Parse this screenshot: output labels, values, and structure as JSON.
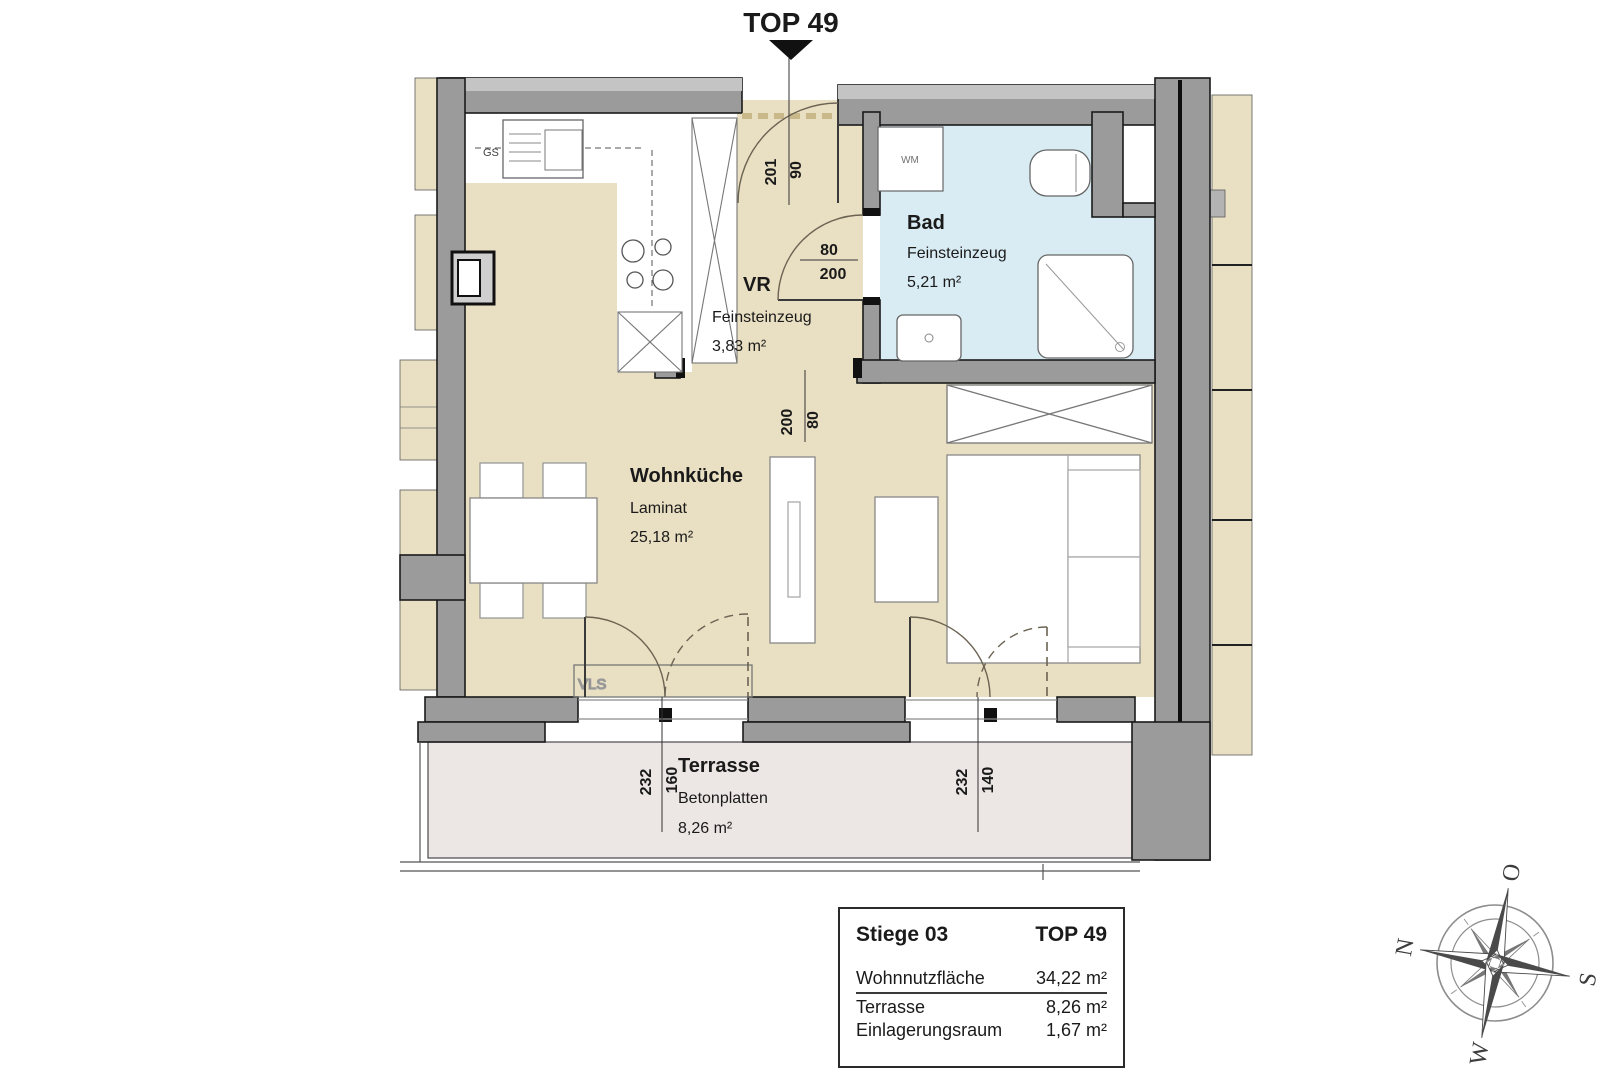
{
  "plan": {
    "top_label": "TOP 49",
    "rooms": {
      "bad": {
        "name": "Bad",
        "floor": "Feinsteinzeug",
        "area": "5,21 m²"
      },
      "vr": {
        "name": "VR",
        "floor": "Feinsteinzeug",
        "area": "3,83 m²"
      },
      "wohnkueche": {
        "name": "Wohnküche",
        "floor": "Laminat",
        "area": "25,18 m²"
      },
      "terrasse": {
        "name": "Terrasse",
        "floor": "Betonplatten",
        "area": "8,26 m²"
      }
    },
    "labels": {
      "vls": "VLS",
      "gs": "GS",
      "wm": "WM"
    },
    "dims": {
      "entrance": {
        "num": "90",
        "den": "201"
      },
      "bad_door": {
        "num": "80",
        "den": "200"
      },
      "vr_opening": {
        "num": "80",
        "den": "200"
      },
      "terrace_left": {
        "depth": "232",
        "width": "160"
      },
      "terrace_right": {
        "depth": "232",
        "width": "140"
      }
    },
    "colors": {
      "wall_gray": "#9b9b9b",
      "floor_beige": "#e9dfc2",
      "bath_blue": "#d9ecf3",
      "terrace_gray": "#ece6e4"
    }
  },
  "info_box": {
    "stiege": "Stiege 03",
    "top": "TOP 49",
    "rows": [
      {
        "label": "Wohnnutzfläche",
        "value": "34,22 m²"
      },
      {
        "label": "Terrasse",
        "value": "8,26 m²"
      },
      {
        "label": "Einlagerungsraum",
        "value": "1,67 m²"
      }
    ]
  },
  "compass": {
    "n": "N",
    "e": "O",
    "s": "S",
    "w": "W"
  }
}
